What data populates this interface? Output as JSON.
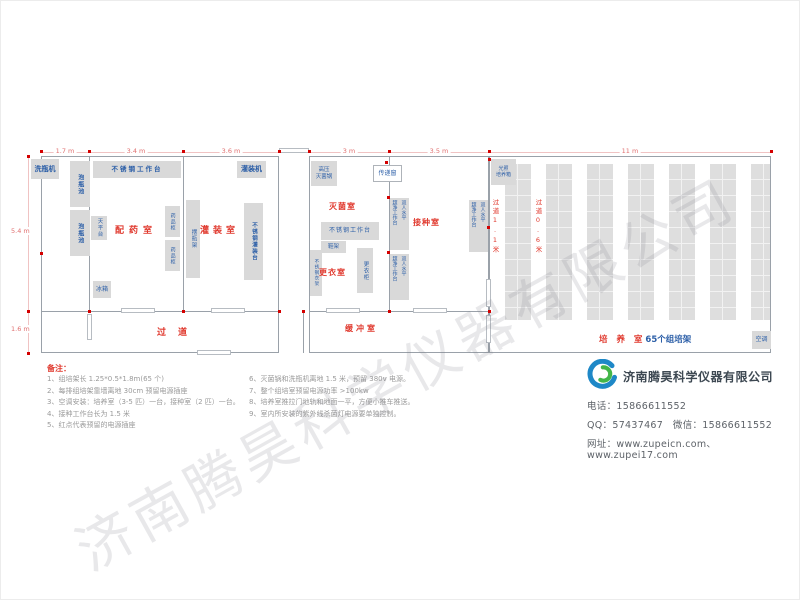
{
  "palette": {
    "room_label_red": "#e0392e",
    "equipment_blue": "#2b5ea7",
    "box_gray": "#d9d9d9",
    "dimension_red": "#e07070",
    "socket_dot_red": "#d40000",
    "wall_gray": "#9aa1a9"
  },
  "dims": {
    "top": [
      "1.7 m",
      "3.4 m",
      "3.6 m",
      "1.3 m",
      "3 m",
      "3.5 m",
      "11 m"
    ],
    "left": [
      "5.4 m",
      "1.6 m"
    ]
  },
  "rooms": {
    "prep": "配药室",
    "fill": "灌装室",
    "steril": "灭菌室",
    "change": "更衣室",
    "inocul": "接种室",
    "corridor": "过道",
    "buffer": "缓冲室",
    "culture": "培 养 室",
    "culture_count": "65个组培架",
    "aisle_1": "过道1.1米",
    "aisle_2": "过道0.6米"
  },
  "equipment": {
    "washer": "洗瓶机",
    "soak_pool": "泡瓶池",
    "ss_bench": "不锈钢工作台",
    "balance_table": "天平台",
    "fridge": "冰箱",
    "medicine_cabinet": "药品柜",
    "bottle_rack": "摆瓶架",
    "filling_machine": "灌装机",
    "ss_filling_table": "不锈钢灌装台",
    "autoclave_l1": "高压",
    "autoclave_l2": "灭菌锅",
    "pass_window": "传递窗",
    "shoe_rack": "鞋架",
    "locker": "更衣柜",
    "ss_coat_rack": "不锈钢衣架",
    "laminar_col1": "双人水平",
    "laminar_col2": "超净工作台",
    "incubator_l1": "光照",
    "incubator_l2": "培养箱",
    "ac": "空调"
  },
  "notes": {
    "heading": "备注：",
    "left": [
      "1、组培架长 1.25*0.5*1.8m(65 个)",
      "2、每排组培架靠墙离地 30cm 预留电源插座",
      "3、空调安装：培养室（3-5 匹）一台，接种室（2 匹）一台。",
      "4、接种工作台长为 1.5 米",
      "5、红点代表预留的电源插座"
    ],
    "right": [
      "6、灭菌锅和洗瓶机离地 1.5 米，预留 380v 电源。",
      "7、整个组培室预留电源功率 >100kw",
      "8、培养室推拉门地轨和地面一平，方便小推车推送。",
      "9、室内所安装的紫外线杀菌灯电源要单独控制。"
    ]
  },
  "company": {
    "name": "济南腾昊科学仪器有限公司",
    "phone_line": "电话：15866611552",
    "qq_line": "QQ：57437467　微信：15866611552",
    "web_line": "网址：www.zupeicn.com、www.zupei17.com"
  },
  "watermark": "济南腾昊科学仪器有限公司"
}
